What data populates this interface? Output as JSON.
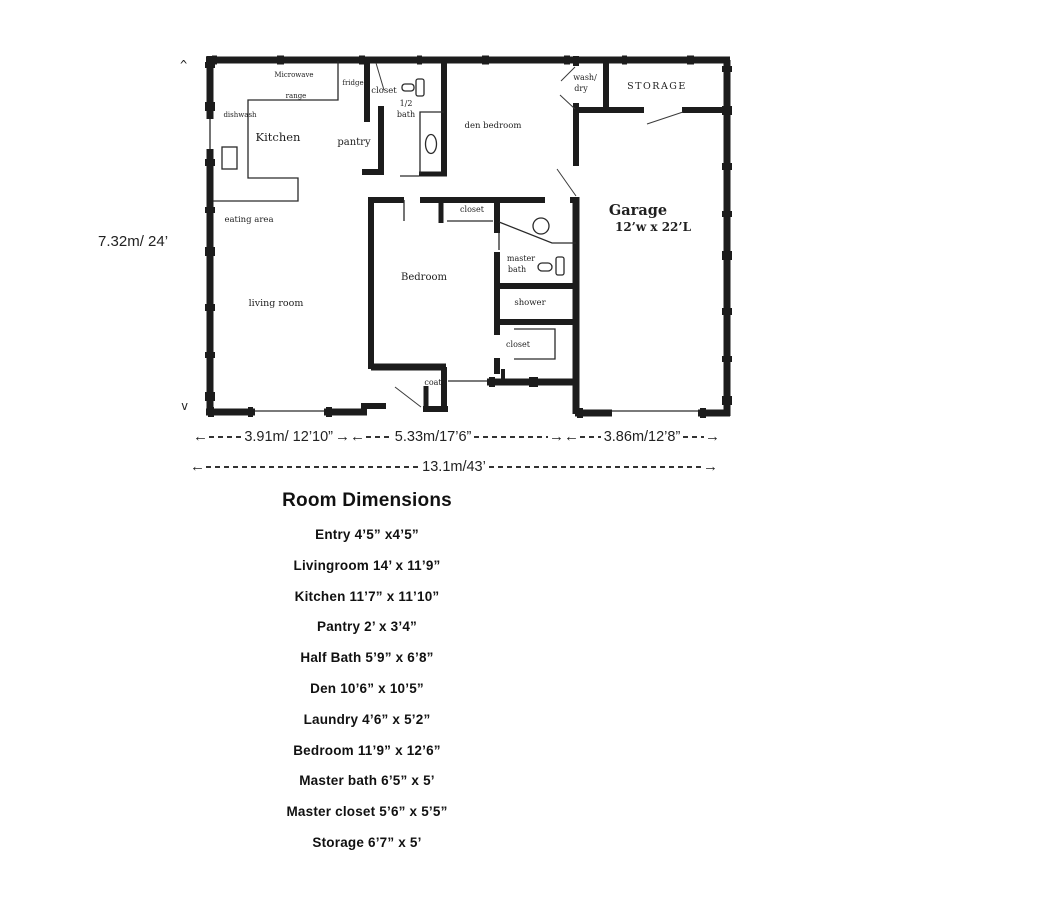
{
  "plan": {
    "labels": {
      "microwave": "Microwave",
      "range": "range",
      "dishwasher": "dishwash",
      "kitchen": "Kitchen",
      "fridge": "fridge",
      "hall_closet": "closet",
      "half_bath_line1": "1/2",
      "half_bath_line2": "bath",
      "pantry": "pantry",
      "den_bedroom": "den bedroom",
      "wash": "wash/",
      "dry": "dry",
      "storage": "STORAGE",
      "garage": "Garage",
      "garage_size": "12’w x 22’L",
      "eating_area": "eating area",
      "living_room": "living room",
      "bedroom": "Bedroom",
      "bedroom_closet": "closet",
      "master_bath_line1": "master",
      "master_bath_line2": "bath",
      "shower": "shower",
      "master_closet": "closet",
      "coat": "coat"
    },
    "markers": {
      "top": "^",
      "bottom": "v"
    }
  },
  "dimensions": {
    "height": "7.32m/ 24’",
    "width_segments": [
      {
        "label": "3.91m/ 12’10”"
      },
      {
        "label": "5.33m/17’6”"
      },
      {
        "label": "3.86m/12’8”"
      }
    ],
    "total_width": "13.1m/43’"
  },
  "room_list": {
    "title": "Room Dimensions",
    "items": [
      "Entry  4’5” x4’5”",
      "Livingroom 14’ x 11’9”",
      "Kitchen 11’7” x 11’10”",
      "Pantry 2’ x 3’4”",
      "Half Bath 5’9” x 6’8”",
      "Den 10’6” x 10’5”",
      "Laundry 4’6” x 5’2”",
      "Bedroom 11’9” x 12’6”",
      "Master bath 6’5” x 5’",
      "Master closet 5’6” x 5’5”",
      "Storage 6’7” x 5’"
    ]
  }
}
